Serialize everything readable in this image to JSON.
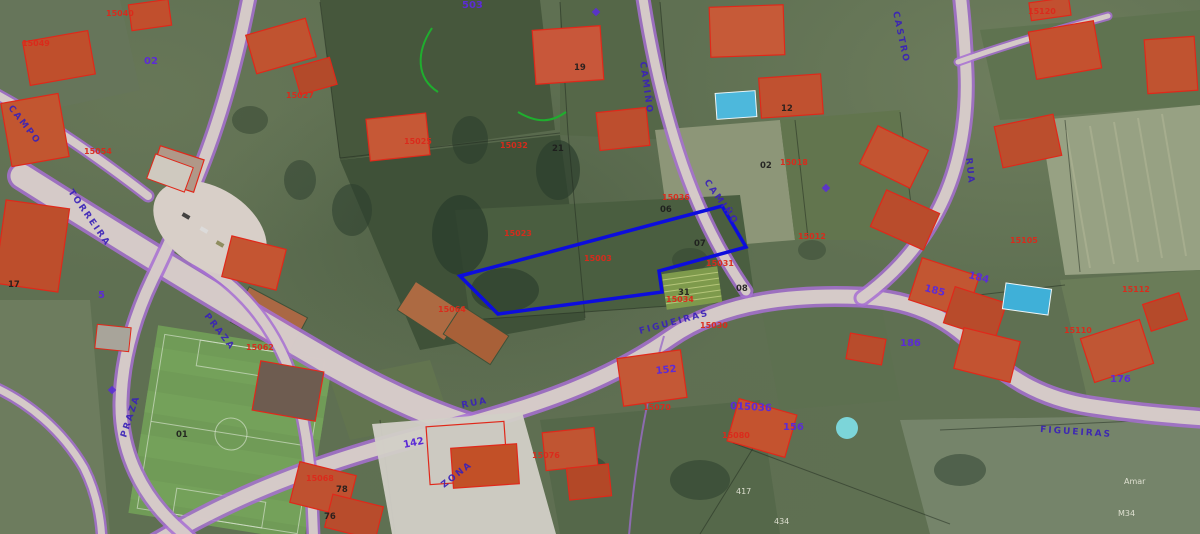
{
  "map": {
    "view": "aerial-orthophoto-with-cadastral-overlay",
    "colors": {
      "road_casing_purple": "#a770d2",
      "road_fill_grey": "#d8cfc8",
      "street_label_blue": "#3a22b8",
      "house_number_purple": "#5c2bd6",
      "parcel_code_red": "#dc291b",
      "parcel_code_black": "#1c1c1c",
      "annotation_gray": "#e9e9db",
      "selected_parcel_blue": "#0d0ddd",
      "pool_blue": "#4db8dc",
      "overlay_green": "#1fae2e"
    }
  },
  "highlight_parcel": {
    "points": "460,276 722,206 746,247 659,271 662,292 498,314",
    "color": "#0d0ddd"
  },
  "labels": {
    "streets": [
      {
        "text": "CAMPO",
        "x": 8,
        "y": 108,
        "r": 52
      },
      {
        "text": "TORREIRA",
        "x": 68,
        "y": 192,
        "r": 55
      },
      {
        "text": "CAMIÑO",
        "x": 640,
        "y": 62,
        "r": 82
      },
      {
        "text": "CAMIÑO",
        "x": 704,
        "y": 182,
        "r": 55
      },
      {
        "text": "CASTRO",
        "x": 893,
        "y": 12,
        "r": 78
      },
      {
        "text": "FIGUEIRAS",
        "x": 640,
        "y": 334,
        "r": -15
      },
      {
        "text": "FIGUEIRAS",
        "x": 1040,
        "y": 432,
        "r": 4
      },
      {
        "text": "RUA",
        "x": 966,
        "y": 158,
        "r": 84
      },
      {
        "text": "RUA",
        "x": 462,
        "y": 408,
        "r": -11
      },
      {
        "text": "PRAZA",
        "x": 204,
        "y": 316,
        "r": 52
      },
      {
        "text": "PRAZA",
        "x": 126,
        "y": 438,
        "r": -72
      },
      {
        "text": "ZONA",
        "x": 444,
        "y": 488,
        "r": -38,
        "size": 14
      }
    ],
    "house_numbers": [
      {
        "text": "142",
        "x": 404,
        "y": 448,
        "r": -12,
        "size": 13
      },
      {
        "text": "152",
        "x": 656,
        "y": 374,
        "r": -6,
        "size": 11
      },
      {
        "text": "185",
        "x": 924,
        "y": 291,
        "r": 14,
        "size": 10
      },
      {
        "text": "184",
        "x": 968,
        "y": 278,
        "r": 14,
        "size": 10
      },
      {
        "text": "186",
        "x": 900,
        "y": 346,
        "size": 10
      },
      {
        "text": "156",
        "x": 783,
        "y": 430,
        "size": 10
      },
      {
        "text": "176",
        "x": 1110,
        "y": 382,
        "size": 10
      },
      {
        "text": "015036",
        "x": 730,
        "y": 409,
        "r": 3,
        "size": 9
      },
      {
        "text": "02",
        "x": 144,
        "y": 64,
        "size": 9
      },
      {
        "text": "5",
        "x": 98,
        "y": 298,
        "size": 9
      },
      {
        "text": "503",
        "x": 462,
        "y": 8,
        "size": 8
      }
    ],
    "parcel_codes_red": [
      {
        "text": "15040",
        "x": 106,
        "y": 16
      },
      {
        "text": "15049",
        "x": 22,
        "y": 46
      },
      {
        "text": "15027",
        "x": 286,
        "y": 98
      },
      {
        "text": "15054",
        "x": 84,
        "y": 154
      },
      {
        "text": "15025",
        "x": 404,
        "y": 144
      },
      {
        "text": "15032",
        "x": 500,
        "y": 148
      },
      {
        "text": "15023",
        "x": 504,
        "y": 236
      },
      {
        "text": "15003",
        "x": 584,
        "y": 261
      },
      {
        "text": "15036",
        "x": 662,
        "y": 200
      },
      {
        "text": "15031",
        "x": 706,
        "y": 266
      },
      {
        "text": "15034",
        "x": 666,
        "y": 302
      },
      {
        "text": "15030",
        "x": 700,
        "y": 328
      },
      {
        "text": "15018",
        "x": 780,
        "y": 165
      },
      {
        "text": "15012",
        "x": 798,
        "y": 239
      },
      {
        "text": "15105",
        "x": 1010,
        "y": 243
      },
      {
        "text": "15120",
        "x": 1028,
        "y": 14
      },
      {
        "text": "15112",
        "x": 1122,
        "y": 292
      },
      {
        "text": "15110",
        "x": 1064,
        "y": 333
      },
      {
        "text": "15062",
        "x": 246,
        "y": 350
      },
      {
        "text": "15064",
        "x": 438,
        "y": 312
      },
      {
        "text": "15070",
        "x": 643,
        "y": 410
      },
      {
        "text": "15076",
        "x": 532,
        "y": 458
      },
      {
        "text": "15080",
        "x": 722,
        "y": 438
      },
      {
        "text": "15068",
        "x": 306,
        "y": 481
      }
    ],
    "parcel_codes_black": [
      {
        "text": "06",
        "x": 660,
        "y": 212
      },
      {
        "text": "07",
        "x": 694,
        "y": 246
      },
      {
        "text": "08",
        "x": 736,
        "y": 291
      },
      {
        "text": "31",
        "x": 678,
        "y": 295
      },
      {
        "text": "21",
        "x": 552,
        "y": 151
      },
      {
        "text": "19",
        "x": 574,
        "y": 70
      },
      {
        "text": "12",
        "x": 781,
        "y": 111
      },
      {
        "text": "02",
        "x": 760,
        "y": 168
      },
      {
        "text": "01",
        "x": 176,
        "y": 437
      },
      {
        "text": "17",
        "x": 8,
        "y": 287
      },
      {
        "text": "78",
        "x": 336,
        "y": 492
      },
      {
        "text": "76",
        "x": 324,
        "y": 519
      }
    ],
    "misc_gray": [
      {
        "text": "417",
        "x": 736,
        "y": 494
      },
      {
        "text": "434",
        "x": 774,
        "y": 524
      },
      {
        "text": "M34",
        "x": 1118,
        "y": 516
      },
      {
        "text": "Amar",
        "x": 1124,
        "y": 484
      }
    ]
  }
}
